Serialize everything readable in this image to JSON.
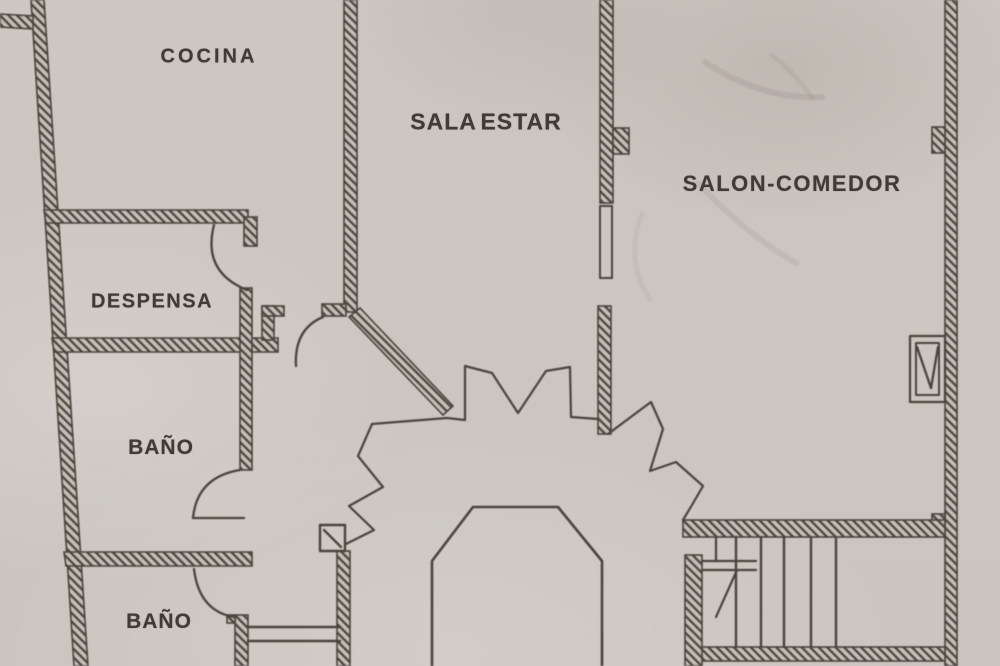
{
  "document_type": "scanned floor plan drawing",
  "plan": {
    "rooms": [
      {
        "id": "cocina",
        "label": "COCINA"
      },
      {
        "id": "sala-estar",
        "label": "SALA ESTAR"
      },
      {
        "id": "salon-comedor",
        "label": "SALON-COMEDOR"
      },
      {
        "id": "despensa",
        "label": "DESPENSA"
      },
      {
        "id": "bano-1",
        "label": "BAÑO"
      },
      {
        "id": "bano-2",
        "label": "BAÑO"
      }
    ],
    "colors": {
      "paper": "#cdc7c1",
      "ink": "#4a433c"
    }
  }
}
